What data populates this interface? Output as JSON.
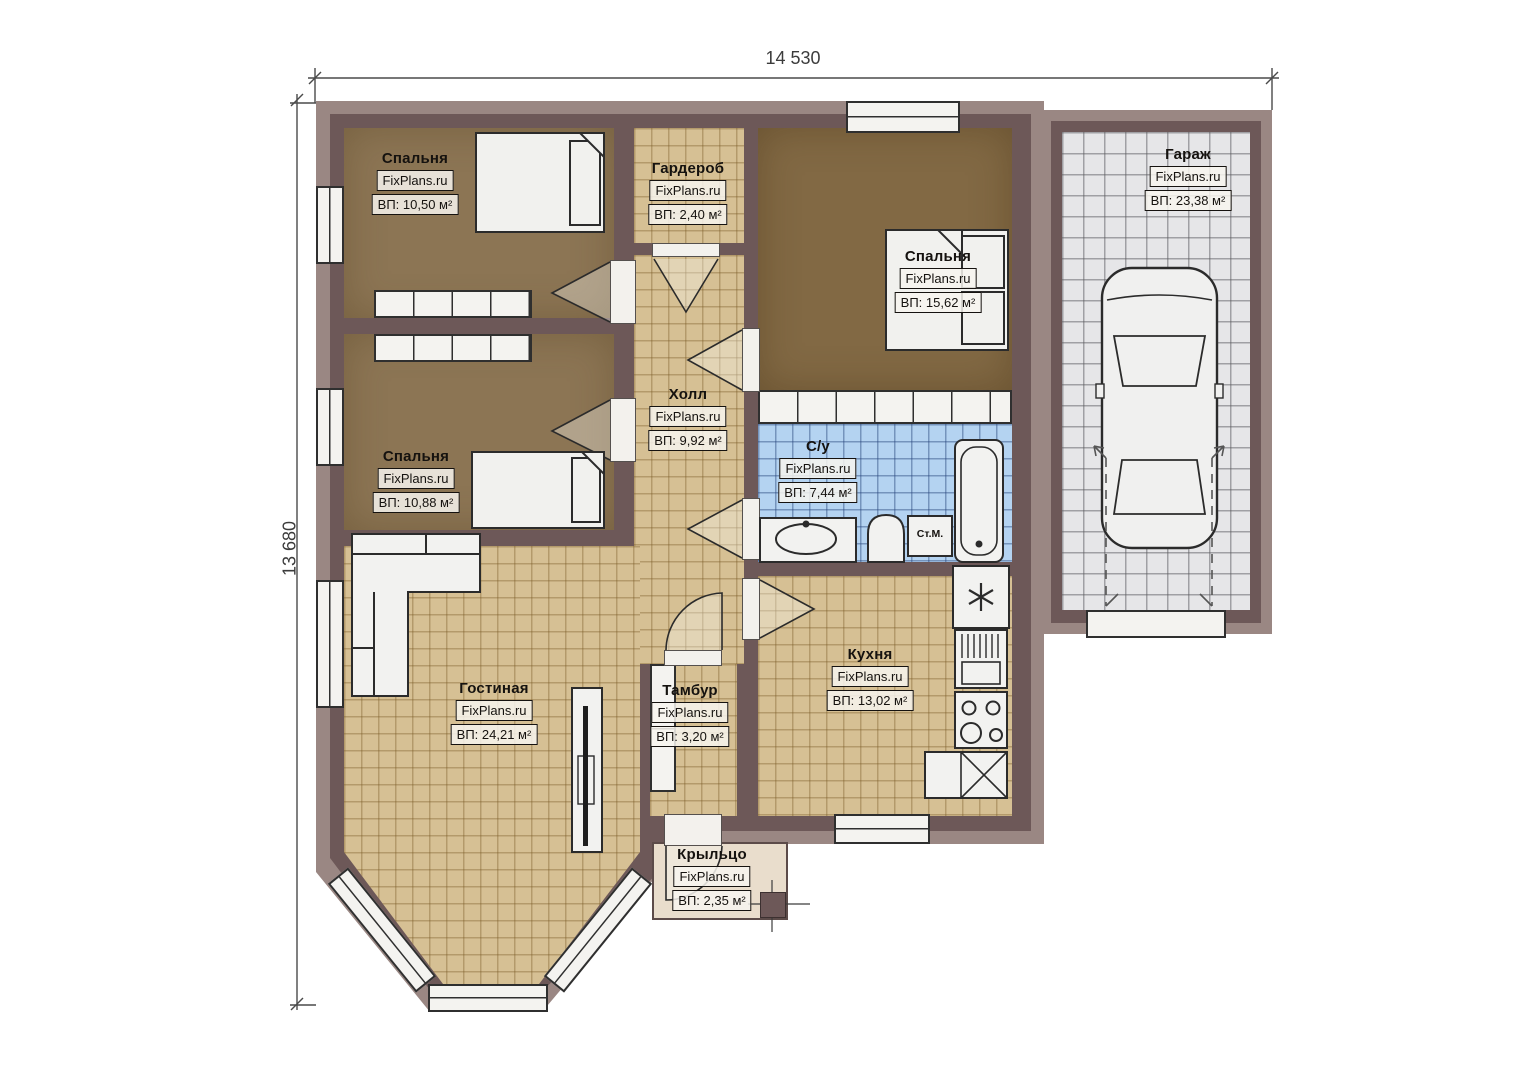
{
  "plan": {
    "type": "single-storey house floor plan",
    "watermark": "FixPlans.ru"
  },
  "dimensions": {
    "width": "14 530",
    "height": "13 680"
  },
  "rooms": [
    {
      "id": "bedroom-top-left",
      "name": "Спальня",
      "brand": "FixPlans.ru",
      "area": "ВП: 10,50 м²"
    },
    {
      "id": "wardrobe",
      "name": "Гардероб",
      "brand": "FixPlans.ru",
      "area": "ВП: 2,40 м²"
    },
    {
      "id": "bedroom-right",
      "name": "Спальня",
      "brand": "FixPlans.ru",
      "area": "ВП: 15,62 м²"
    },
    {
      "id": "garage",
      "name": "Гараж",
      "brand": "FixPlans.ru",
      "area": "ВП: 23,38 м²"
    },
    {
      "id": "hall",
      "name": "Холл",
      "brand": "FixPlans.ru",
      "area": "ВП: 9,92 м²"
    },
    {
      "id": "bathroom",
      "name": "С/у",
      "brand": "FixPlans.ru",
      "area": "ВП: 7,44 м²"
    },
    {
      "id": "bedroom-mid-left",
      "name": "Спальня",
      "brand": "FixPlans.ru",
      "area": "ВП: 10,88 м²"
    },
    {
      "id": "living-room",
      "name": "Гостиная",
      "brand": "FixPlans.ru",
      "area": "ВП: 24,21 м²"
    },
    {
      "id": "vestibule",
      "name": "Тамбур",
      "brand": "FixPlans.ru",
      "area": "ВП: 3,20 м²"
    },
    {
      "id": "kitchen",
      "name": "Кухня",
      "brand": "FixPlans.ru",
      "area": "ВП: 13,02 м²"
    },
    {
      "id": "porch",
      "name": "Крыльцо",
      "brand": "FixPlans.ru",
      "area": "ВП: 2,35 м²"
    }
  ],
  "fixtures": {
    "washing_machine": "Ст.М."
  },
  "colors": {
    "wall_core": "#6d5858",
    "wall_band": "#9a8783",
    "tile_floor": "#d6c094",
    "bathroom_tile": "#b4d3f1",
    "garage_floor": "#e6e6e8",
    "bedroom_carpet": "#8c7554",
    "porch_floor": "#e9ddcc"
  }
}
